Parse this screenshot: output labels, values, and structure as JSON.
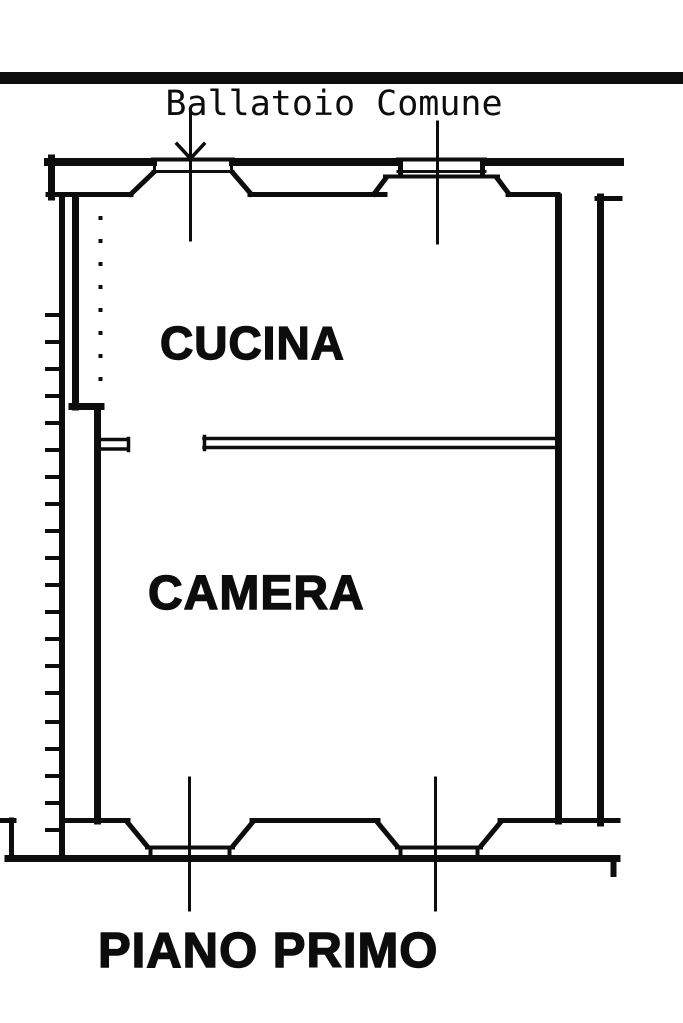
{
  "plan": {
    "floor_label": "PIANO PRIMO",
    "balcony_label": "Ballatoio Comune",
    "rooms": [
      {
        "name": "CUCINA"
      },
      {
        "name": "CAMERA"
      }
    ]
  },
  "colors": {
    "ink": "#0d0d0d",
    "paper": "#ffffff"
  }
}
